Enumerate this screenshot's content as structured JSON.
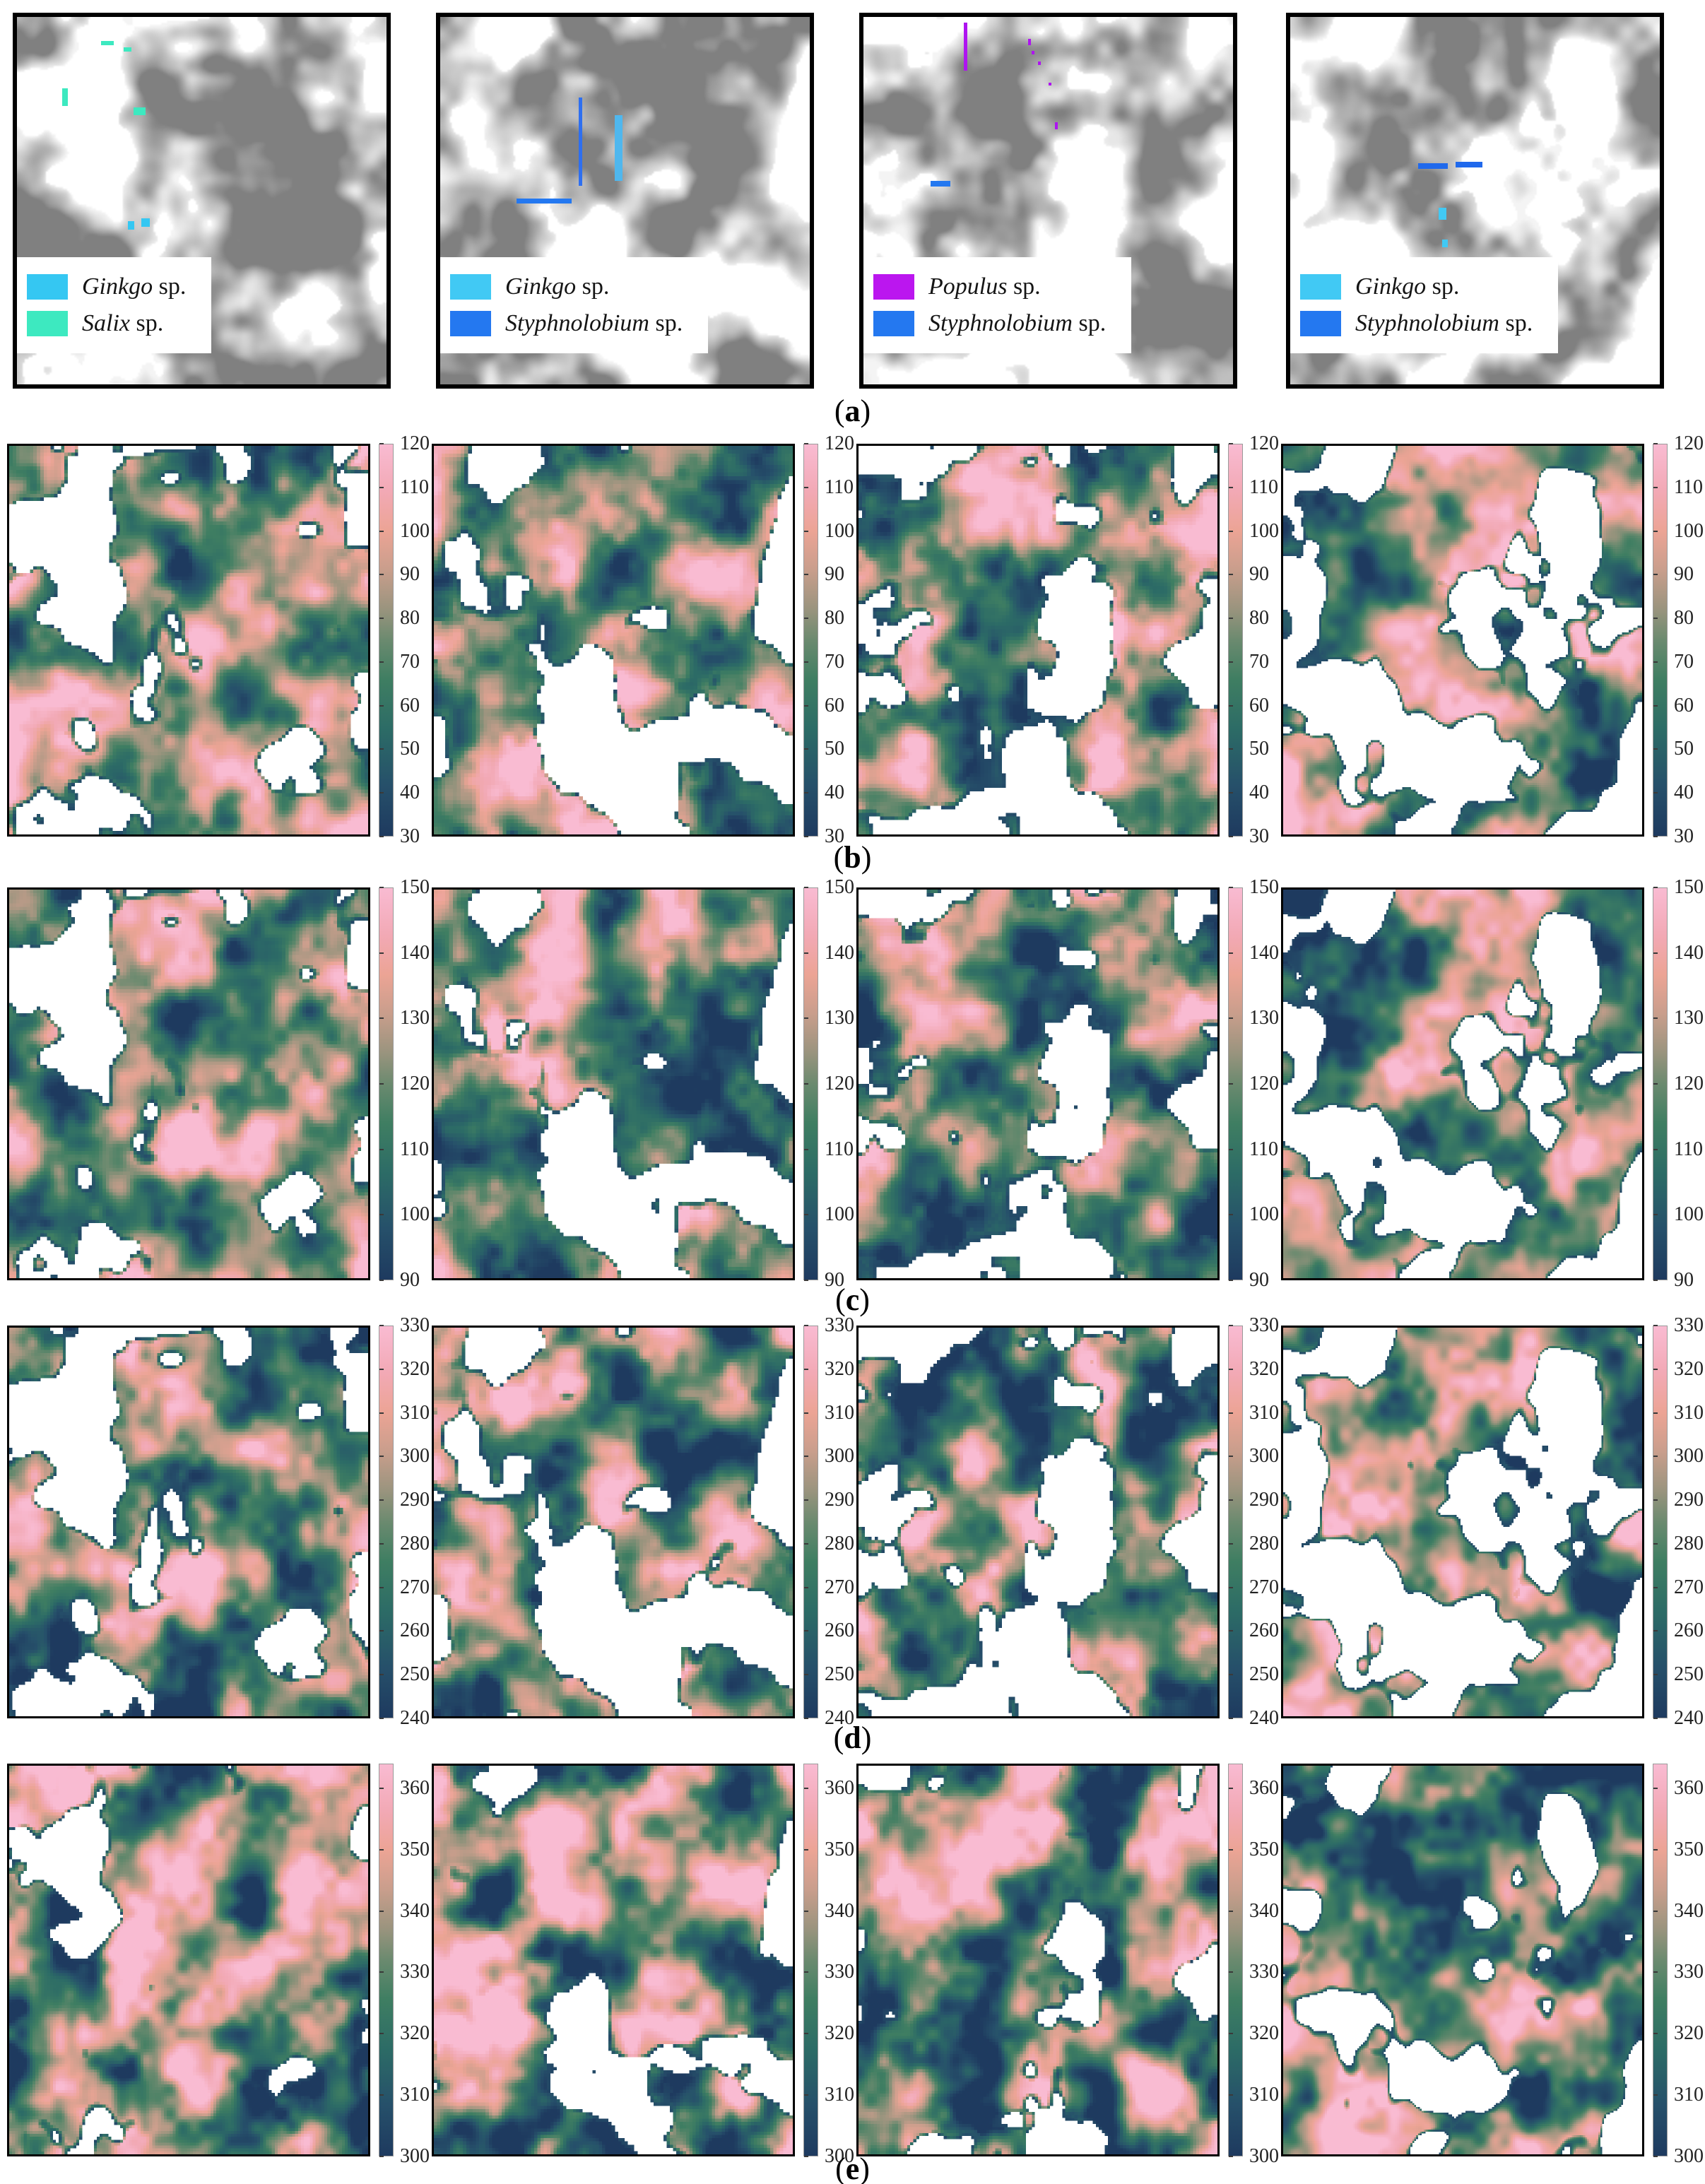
{
  "row_labels": [
    {
      "prefix": "(",
      "letter": "a",
      "suffix": ")"
    },
    {
      "prefix": "(",
      "letter": "b",
      "suffix": ")"
    },
    {
      "prefix": "(",
      "letter": "c",
      "suffix": ")"
    },
    {
      "prefix": "(",
      "letter": "d",
      "suffix": ")"
    },
    {
      "prefix": "(",
      "letter": "e",
      "suffix": ")"
    }
  ],
  "species_colors": {
    "ginkgo": "#35C7F2",
    "salix": "#3DE9C0",
    "styphnolobium": "#2478F0",
    "populus": "#BB16EF"
  },
  "row_a": {
    "panels": [
      {
        "legend": [
          {
            "genus": "Ginkgo",
            "suffix": " sp.",
            "color": "#35C7F2"
          },
          {
            "genus": "Salix",
            "suffix": " sp.",
            "color": "#3DE9C0"
          }
        ],
        "marks": [
          {
            "c": "#3DE9C0",
            "x": 12.3,
            "y": 19.4,
            "w": 1.5,
            "h": 4.8
          },
          {
            "c": "#3DE9C0",
            "x": 22.8,
            "y": 6.6,
            "w": 3.4,
            "h": 1.1
          },
          {
            "c": "#3DE9C0",
            "x": 28.8,
            "y": 8.2,
            "w": 2.2,
            "h": 1.3
          },
          {
            "c": "#3DE9C0",
            "x": 31.6,
            "y": 24.6,
            "w": 3.2,
            "h": 2.1
          },
          {
            "c": "#35C7F2",
            "x": 30.0,
            "y": 55.6,
            "w": 1.8,
            "h": 2.2
          },
          {
            "c": "#35C7F2",
            "x": 33.6,
            "y": 54.8,
            "w": 2.4,
            "h": 2.3
          }
        ]
      },
      {
        "legend": [
          {
            "genus": "Ginkgo",
            "suffix": " sp.",
            "color": "#41C9F4"
          },
          {
            "genus": "Styphnolobium",
            "suffix": " sp.",
            "color": "#2478F0"
          }
        ],
        "marks": [
          {
            "c": "#2E6FF0",
            "x": 37.4,
            "y": 22.0,
            "w": 1.0,
            "h": 24.0
          },
          {
            "c": "#4FB7EE",
            "x": 47.3,
            "y": 26.7,
            "w": 2.0,
            "h": 18.0
          },
          {
            "c": "#2478F0",
            "x": 20.6,
            "y": 49.4,
            "w": 15.0,
            "h": 1.3
          }
        ]
      },
      {
        "legend": [
          {
            "genus": "Populus",
            "suffix": " sp.",
            "color": "#BB16EF"
          },
          {
            "genus": "Styphnolobium",
            "suffix": " sp.",
            "color": "#2478F0"
          }
        ],
        "marks": [
          {
            "c": "#AE14F0",
            "x": 27.1,
            "y": 1.5,
            "w": 1.1,
            "h": 13.2
          },
          {
            "c": "#AE14F0",
            "x": 44.5,
            "y": 6.0,
            "w": 0.7,
            "h": 1.6
          },
          {
            "c": "#AE14F0",
            "x": 45.6,
            "y": 9.2,
            "w": 0.7,
            "h": 0.9
          },
          {
            "c": "#AE14F0",
            "x": 47.3,
            "y": 12.2,
            "w": 0.7,
            "h": 0.9
          },
          {
            "c": "#AE14F0",
            "x": 50.0,
            "y": 17.8,
            "w": 0.7,
            "h": 0.9
          },
          {
            "c": "#AE14F0",
            "x": 51.8,
            "y": 28.6,
            "w": 0.7,
            "h": 2.0
          },
          {
            "c": "#2478F0",
            "x": 18.1,
            "y": 44.7,
            "w": 5.4,
            "h": 1.4
          }
        ]
      },
      {
        "legend": [
          {
            "genus": "Ginkgo",
            "suffix": " sp.",
            "color": "#41C9F4"
          },
          {
            "genus": "Styphnolobium",
            "suffix": " sp.",
            "color": "#2478F0"
          }
        ],
        "marks": [
          {
            "c": "#2069EC",
            "x": 34.6,
            "y": 39.8,
            "w": 8.0,
            "h": 1.6
          },
          {
            "c": "#2069EC",
            "x": 44.7,
            "y": 39.4,
            "w": 7.3,
            "h": 1.6
          },
          {
            "c": "#41C9F4",
            "x": 40.2,
            "y": 52.0,
            "w": 2.1,
            "h": 3.2
          },
          {
            "c": "#41C9F4",
            "x": 41.1,
            "y": 60.5,
            "w": 1.5,
            "h": 2.1
          }
        ]
      }
    ]
  },
  "heat_rows": [
    {
      "colorbar": {
        "min": 30,
        "max": 120,
        "ticks": [
          30,
          40,
          50,
          60,
          70,
          80,
          90,
          100,
          110,
          120
        ]
      }
    },
    {
      "colorbar": {
        "min": 90,
        "max": 150,
        "ticks": [
          90,
          100,
          110,
          120,
          130,
          140,
          150
        ]
      }
    },
    {
      "colorbar": {
        "min": 240,
        "max": 330,
        "ticks": [
          240,
          250,
          260,
          270,
          280,
          290,
          300,
          310,
          320,
          330
        ]
      }
    },
    {
      "colorbar": {
        "min": 300,
        "max": 364,
        "ticks": [
          300,
          310,
          320,
          330,
          340,
          350,
          360
        ]
      }
    }
  ],
  "colormap": [
    {
      "pos": 0.0,
      "color": "#1E3A5F"
    },
    {
      "pos": 0.13,
      "color": "#26506A"
    },
    {
      "pos": 0.27,
      "color": "#2C6B66"
    },
    {
      "pos": 0.4,
      "color": "#3F7E62"
    },
    {
      "pos": 0.5,
      "color": "#6B8A6F"
    },
    {
      "pos": 0.58,
      "color": "#9A947E"
    },
    {
      "pos": 0.68,
      "color": "#C99E8C"
    },
    {
      "pos": 0.78,
      "color": "#ECA495"
    },
    {
      "pos": 0.88,
      "color": "#F2A9B5"
    },
    {
      "pos": 1.0,
      "color": "#F9BBD2"
    }
  ],
  "chart_data": [
    {
      "type": "heatmap",
      "row": "a",
      "panels": 4,
      "description_visible_legends": [
        [
          "Ginkgo sp.",
          "Salix sp."
        ],
        [
          "Ginkgo sp.",
          "Styphnolobium sp."
        ],
        [
          "Populus sp.",
          "Styphnolobium sp."
        ],
        [
          "Ginkgo sp.",
          "Styphnolobium sp."
        ]
      ]
    },
    {
      "type": "heatmap",
      "row": "b",
      "panels": 4,
      "colorbar_range": [
        30,
        120
      ],
      "colorbar_ticks": [
        30,
        40,
        50,
        60,
        70,
        80,
        90,
        100,
        110,
        120
      ],
      "legend_position": "right-colorbar"
    },
    {
      "type": "heatmap",
      "row": "c",
      "panels": 4,
      "colorbar_range": [
        90,
        150
      ],
      "colorbar_ticks": [
        90,
        100,
        110,
        120,
        130,
        140,
        150
      ],
      "legend_position": "right-colorbar"
    },
    {
      "type": "heatmap",
      "row": "d",
      "panels": 4,
      "colorbar_range": [
        240,
        330
      ],
      "colorbar_ticks": [
        240,
        250,
        260,
        270,
        280,
        290,
        300,
        310,
        320,
        330
      ],
      "legend_position": "right-colorbar"
    },
    {
      "type": "heatmap",
      "row": "e",
      "panels": 4,
      "colorbar_range": [
        300,
        360
      ],
      "colorbar_ticks": [
        300,
        310,
        320,
        330,
        340,
        350,
        360
      ],
      "legend_position": "right-colorbar"
    }
  ]
}
